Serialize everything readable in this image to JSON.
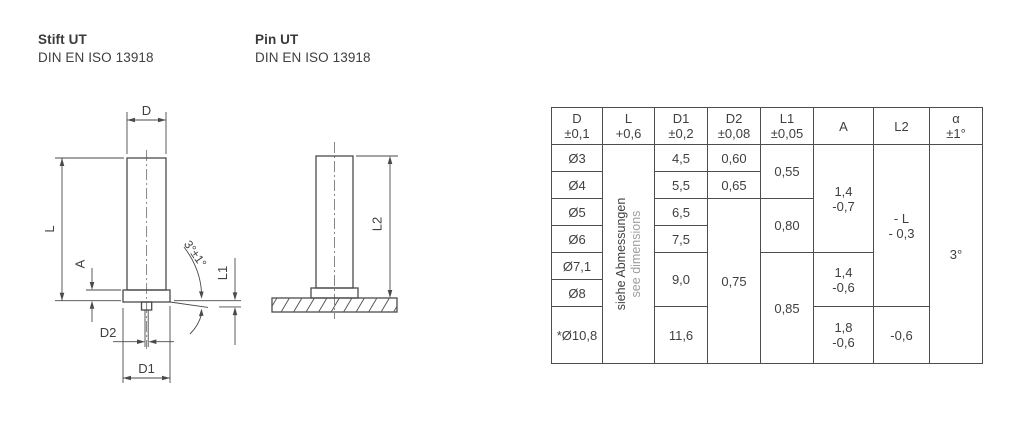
{
  "titles": {
    "de": {
      "name": "Stift UT",
      "standard": "DIN EN ISO 13918"
    },
    "en": {
      "name": "Pin UT",
      "standard": "DIN EN ISO 13918"
    }
  },
  "drawing": {
    "labels": {
      "d": "D",
      "l": "L",
      "a": "A",
      "d2": "D2",
      "d1": "D1",
      "l1": "L1",
      "l2": "L2",
      "angle": "3°±1°"
    }
  },
  "table": {
    "headers": [
      {
        "line1": "D",
        "line2": "±0,1"
      },
      {
        "line1": "L",
        "line2": "+0,6"
      },
      {
        "line1": "D1",
        "line2": "±0,2"
      },
      {
        "line1": "D2",
        "line2": "±0,08"
      },
      {
        "line1": "L1",
        "line2": "±0,05"
      },
      {
        "line1": "A",
        "line2": ""
      },
      {
        "line1": "L2",
        "line2": ""
      },
      {
        "line1": "α",
        "line2": "±1°"
      }
    ],
    "l_note_de": "siehe Abmessungen",
    "l_note_en": "see dimensions",
    "d": [
      "Ø3",
      "Ø4",
      "Ø5",
      "Ø6",
      "Ø7,1",
      "Ø8",
      "*Ø10,8"
    ],
    "d1": {
      "r1": "4,5",
      "r2": "5,5",
      "r3": "6,5",
      "r4": "7,5",
      "r5_6": "9,0",
      "r7": "11,6"
    },
    "d2": {
      "r1": "0,60",
      "r2": "0,65",
      "r3_7": "0,75"
    },
    "l1": {
      "r1_2": "0,55",
      "r3_4": "0,80",
      "r5_7": "0,85"
    },
    "a": {
      "r1_4": {
        "v": "1,4",
        "t": "-0,7"
      },
      "r5_6": {
        "v": "1,4",
        "t": "-0,6"
      },
      "r7": {
        "v": "1,8",
        "t": "-0,6"
      }
    },
    "l2": {
      "r1_6": {
        "v": "- L",
        "t": "- 0,3"
      },
      "r7": "-0,6"
    },
    "alpha": "3°"
  },
  "colors": {
    "line": "#4a4a4a",
    "text": "#3f3f3f",
    "muted": "#9e9e9e"
  }
}
